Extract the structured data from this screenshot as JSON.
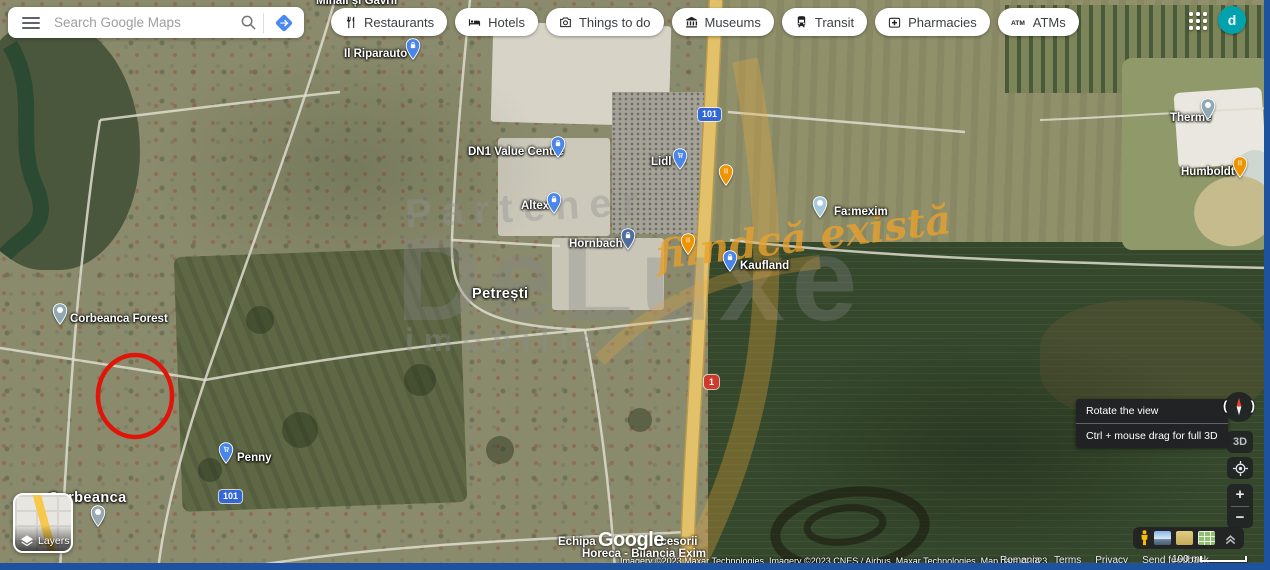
{
  "topbar": {
    "search_placeholder": "Search Google Maps",
    "chips": [
      {
        "label": "Restaurants",
        "icon": "restaurant-icon"
      },
      {
        "label": "Hotels",
        "icon": "hotel-icon"
      },
      {
        "label": "Things to do",
        "icon": "attractions-icon"
      },
      {
        "label": "Museums",
        "icon": "museum-icon"
      },
      {
        "label": "Transit",
        "icon": "transit-icon"
      },
      {
        "label": "Pharmacies",
        "icon": "pharmacy-icon"
      },
      {
        "label": "ATMs",
        "icon": "atm-icon"
      }
    ],
    "avatar_letter": "d"
  },
  "map": {
    "place_labels": [
      {
        "text": "Mihail și Gavril",
        "x": 316,
        "y": -5,
        "size": "normal"
      },
      {
        "text": "Il Riparauto",
        "x": 344,
        "y": 48,
        "size": "normal",
        "pin": {
          "color": "#4a86e8",
          "glyph": "bag",
          "x": 405,
          "y": 38
        }
      },
      {
        "text": "DN1 Value Centre",
        "x": 468,
        "y": 146,
        "size": "normal",
        "pin": {
          "color": "#4a86e8",
          "glyph": "bag",
          "x": 550,
          "y": 136
        }
      },
      {
        "text": "Lidl",
        "x": 651,
        "y": 156,
        "size": "normal",
        "pin": {
          "color": "#4a86e8",
          "glyph": "cart",
          "x": 672,
          "y": 148
        }
      },
      {
        "text": "Altex",
        "x": 521,
        "y": 200,
        "size": "normal",
        "pin": {
          "color": "#4a86e8",
          "glyph": "bag",
          "x": 546,
          "y": 192
        }
      },
      {
        "text": "Hornbach",
        "x": 569,
        "y": 238,
        "size": "normal",
        "pin": {
          "color": "#4e6e9e",
          "glyph": "bag",
          "x": 620,
          "y": 228
        }
      },
      {
        "text": "Kaufland",
        "x": 740,
        "y": 260,
        "size": "normal",
        "pin": {
          "color": "#4a86e8",
          "glyph": "bag",
          "x": 722,
          "y": 250
        }
      },
      {
        "text": "Petrești",
        "x": 472,
        "y": 286,
        "size": "large"
      },
      {
        "text": "Fa:mexim",
        "x": 834,
        "y": 206,
        "size": "normal",
        "pin": {
          "color": "#a8c8de",
          "glyph": "dot",
          "x": 812,
          "y": 196
        }
      },
      {
        "text": "Corbeanca Forest",
        "x": 70,
        "y": 313,
        "size": "normal",
        "pin": {
          "color": "#90a7b6",
          "glyph": "tree",
          "x": 52,
          "y": 303
        }
      },
      {
        "text": "Penny",
        "x": 237,
        "y": 452,
        "size": "normal",
        "pin": {
          "color": "#4a86e8",
          "glyph": "cart",
          "x": 218,
          "y": 442
        }
      },
      {
        "text": "Corbeanca",
        "x": 48,
        "y": 490,
        "size": "large",
        "pin": {
          "color": "#9aa8b2",
          "glyph": "dot",
          "x": 90,
          "y": 505
        }
      },
      {
        "text": "Therme",
        "x": 1170,
        "y": 112,
        "size": "normal",
        "pin": {
          "color": "#90a7b6",
          "glyph": "dot",
          "x": 1200,
          "y": 98
        }
      },
      {
        "text": "Humboldt",
        "x": 1181,
        "y": 166,
        "size": "normal",
        "pin": {
          "color": "#f09300",
          "glyph": "fork",
          "x": 1232,
          "y": 156
        }
      }
    ],
    "standalone_pins": [
      {
        "color": "#f09300",
        "glyph": "fork",
        "x": 680,
        "y": 233
      },
      {
        "color": "#f09300",
        "glyph": "fork",
        "x": 718,
        "y": 164
      }
    ],
    "route_shields": [
      {
        "text": "101",
        "type": "blue",
        "x": 698,
        "y": 108
      },
      {
        "text": "101",
        "type": "blue",
        "x": 219,
        "y": 490
      },
      {
        "text": "1",
        "type": "red",
        "x": 704,
        "y": 375
      }
    ],
    "annotation": {
      "shape": "red-circle",
      "color": "#e01408",
      "cx": 135,
      "cy": 396,
      "rx": 37,
      "ry": 41
    },
    "bottom_business": {
      "line1_left": "Echipa",
      "line1_right": "ccesorii",
      "line2": "Horeca - Bilancia Exim"
    },
    "watermark": {
      "partner": "Partener",
      "brand": "DeLuxe",
      "tagline": "fiindcă există",
      "category": "imobiliare"
    }
  },
  "controls": {
    "rotate_tooltip": {
      "title": "Rotate the view",
      "subtitle": "Ctrl + mouse drag for full 3D"
    },
    "view_3d": "3D",
    "zoom_in": "+",
    "zoom_out": "−",
    "layers_label": "Layers"
  },
  "footer": {
    "logo": "Google",
    "attribution": "Imagery ©2023 Maxar Technologies, Imagery ©2023 CNES / Airbus, Maxar Technologies, Map data ©2023",
    "links": [
      "Romania",
      "Terms",
      "Privacy",
      "Send feedback"
    ],
    "scale_text": "100 m"
  }
}
